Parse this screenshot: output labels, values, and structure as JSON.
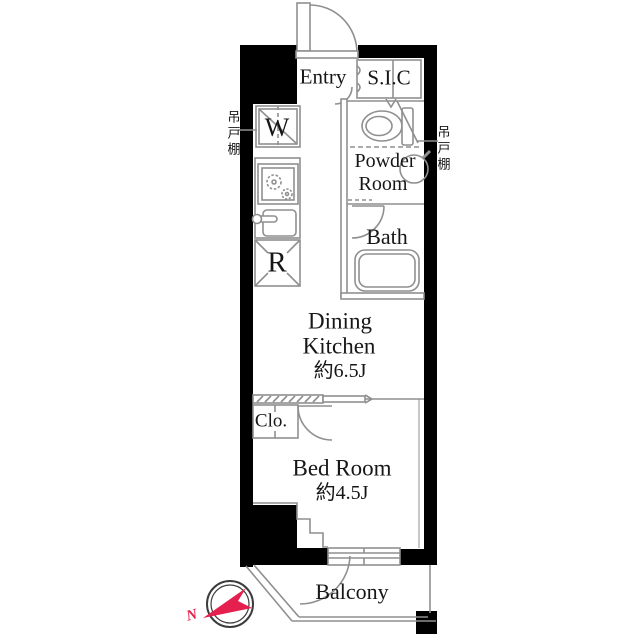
{
  "labels": {
    "entry": "Entry",
    "sic": "S.I.C",
    "washer": "W",
    "refrigerator": "R",
    "powder_line1": "Powder",
    "powder_line2": "Room",
    "bath": "Bath",
    "dk_line1": "Dining",
    "dk_line2": "Kitchen",
    "dk_area": "約6.5J",
    "closet": "Clo.",
    "bedroom": "Bed Room",
    "bedroom_area": "約4.5J",
    "balcony": "Balcony",
    "cupboard_left": "吊戸棚",
    "cupboard_right": "吊戸棚",
    "compass_north": "N"
  },
  "areas": {
    "dining_kitchen_jo": "約6.5J",
    "bedroom_jo": "約4.5J"
  },
  "colors": {
    "wall": "#000000",
    "line": "#8f8f8f",
    "compass_ring": "#3c3c3c",
    "north_red": "#e5204e",
    "text": "#161616",
    "background": "#ffffff"
  }
}
